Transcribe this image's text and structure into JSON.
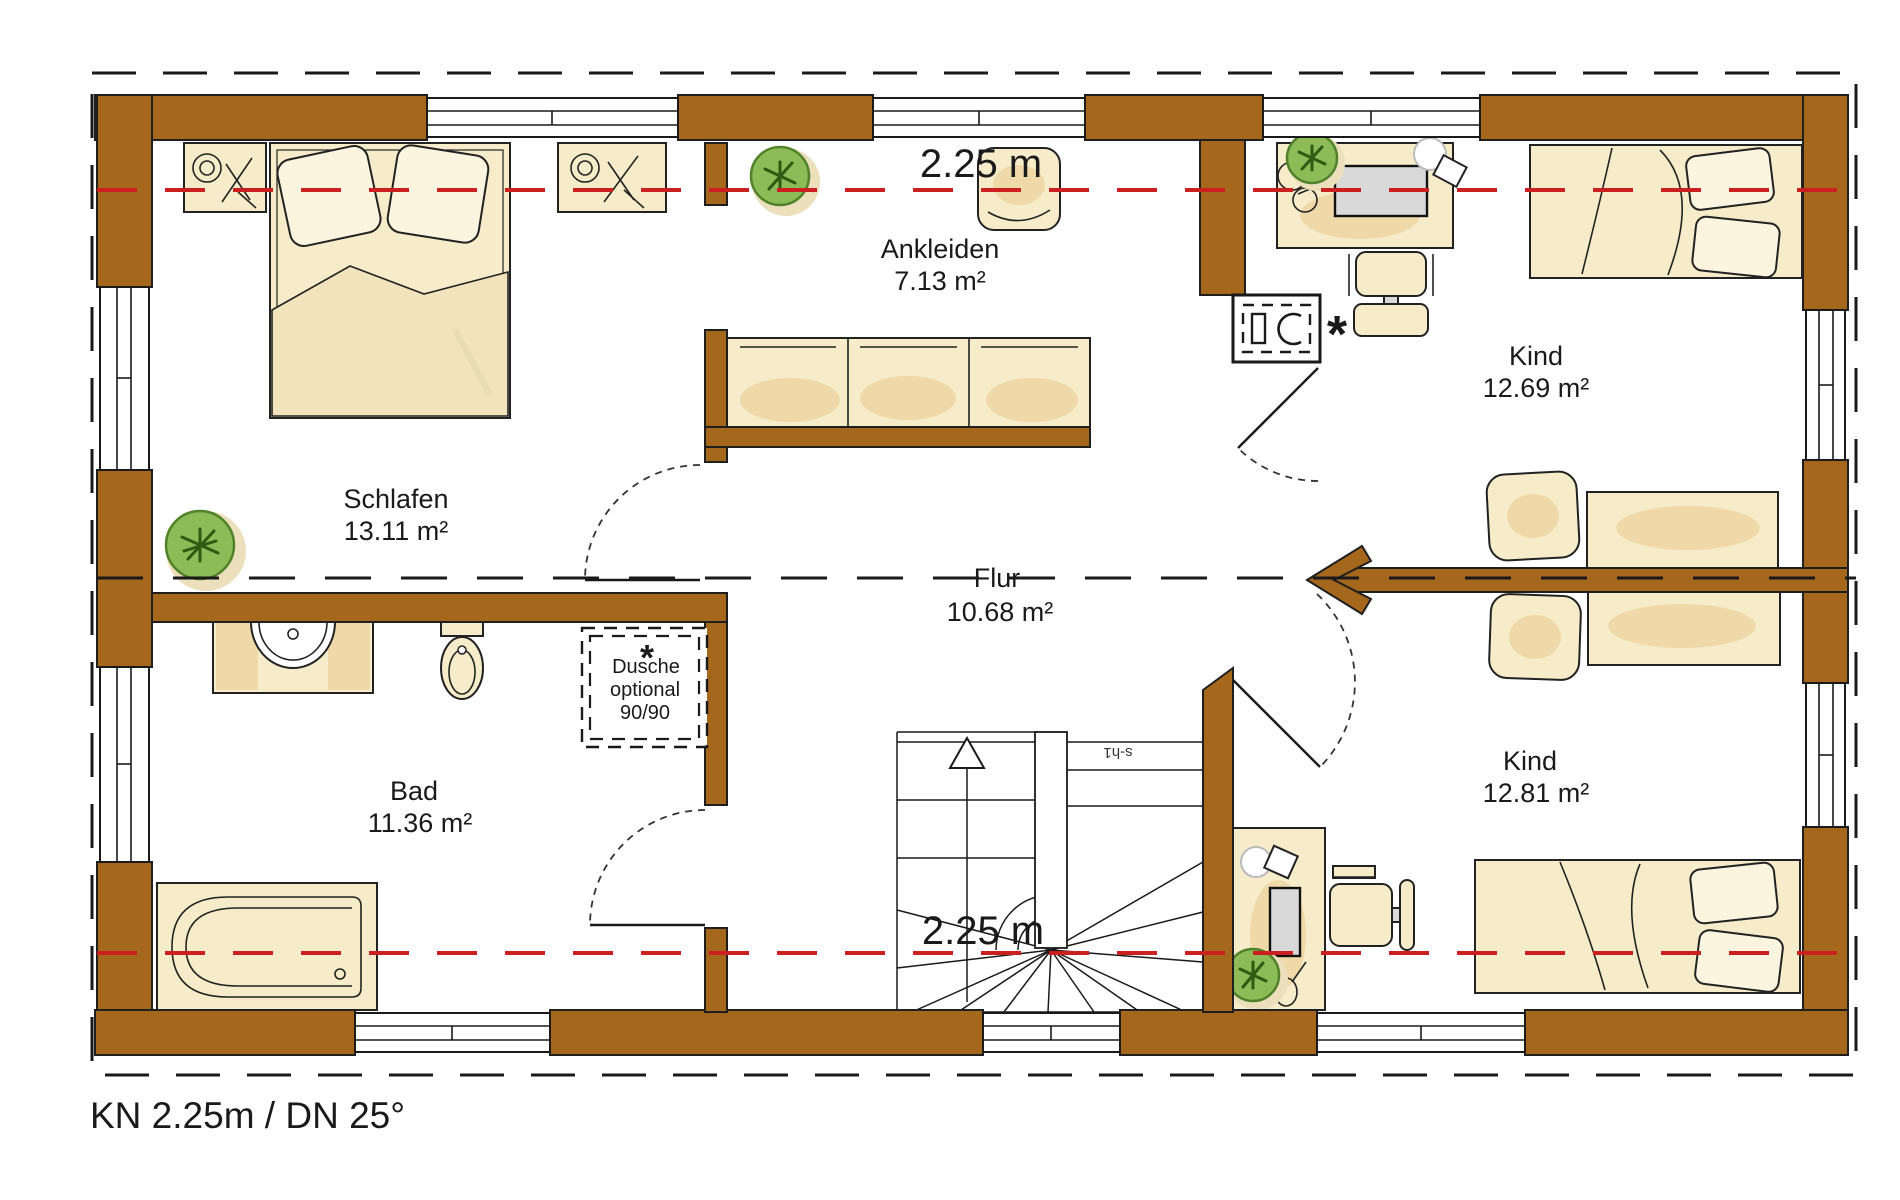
{
  "caption": "KN 2.25m / DN 25°",
  "dimensions": {
    "top": "2.25 m",
    "bottom": "2.25 m"
  },
  "rooms": {
    "schlafen": {
      "name": "Schlafen",
      "area": "13.11 m²"
    },
    "ankleiden": {
      "name": "Ankleiden",
      "area": "7.13 m²"
    },
    "kind_top": {
      "name": "Kind",
      "area": "12.69 m²"
    },
    "flur": {
      "name": "Flur",
      "area": "10.68 m²"
    },
    "bad": {
      "name": "Bad",
      "area": "11.36 m²"
    },
    "kind_bottom": {
      "name": "Kind",
      "area": "12.81 m²"
    }
  },
  "shower_option": {
    "marker": "*",
    "line1": "Dusche",
    "line2": "optional",
    "line3": "90/90"
  },
  "chimney": {
    "marker": "*"
  },
  "stair": {
    "code": "s-h1"
  },
  "colors": {
    "wall": "#A4671C",
    "accent_red": "#CC2020",
    "furniture": "#F6ECC9",
    "furniture_dark": "#EFD9A8",
    "plant": "#8CBB57",
    "monitor_grey": "#D9D9D9"
  }
}
